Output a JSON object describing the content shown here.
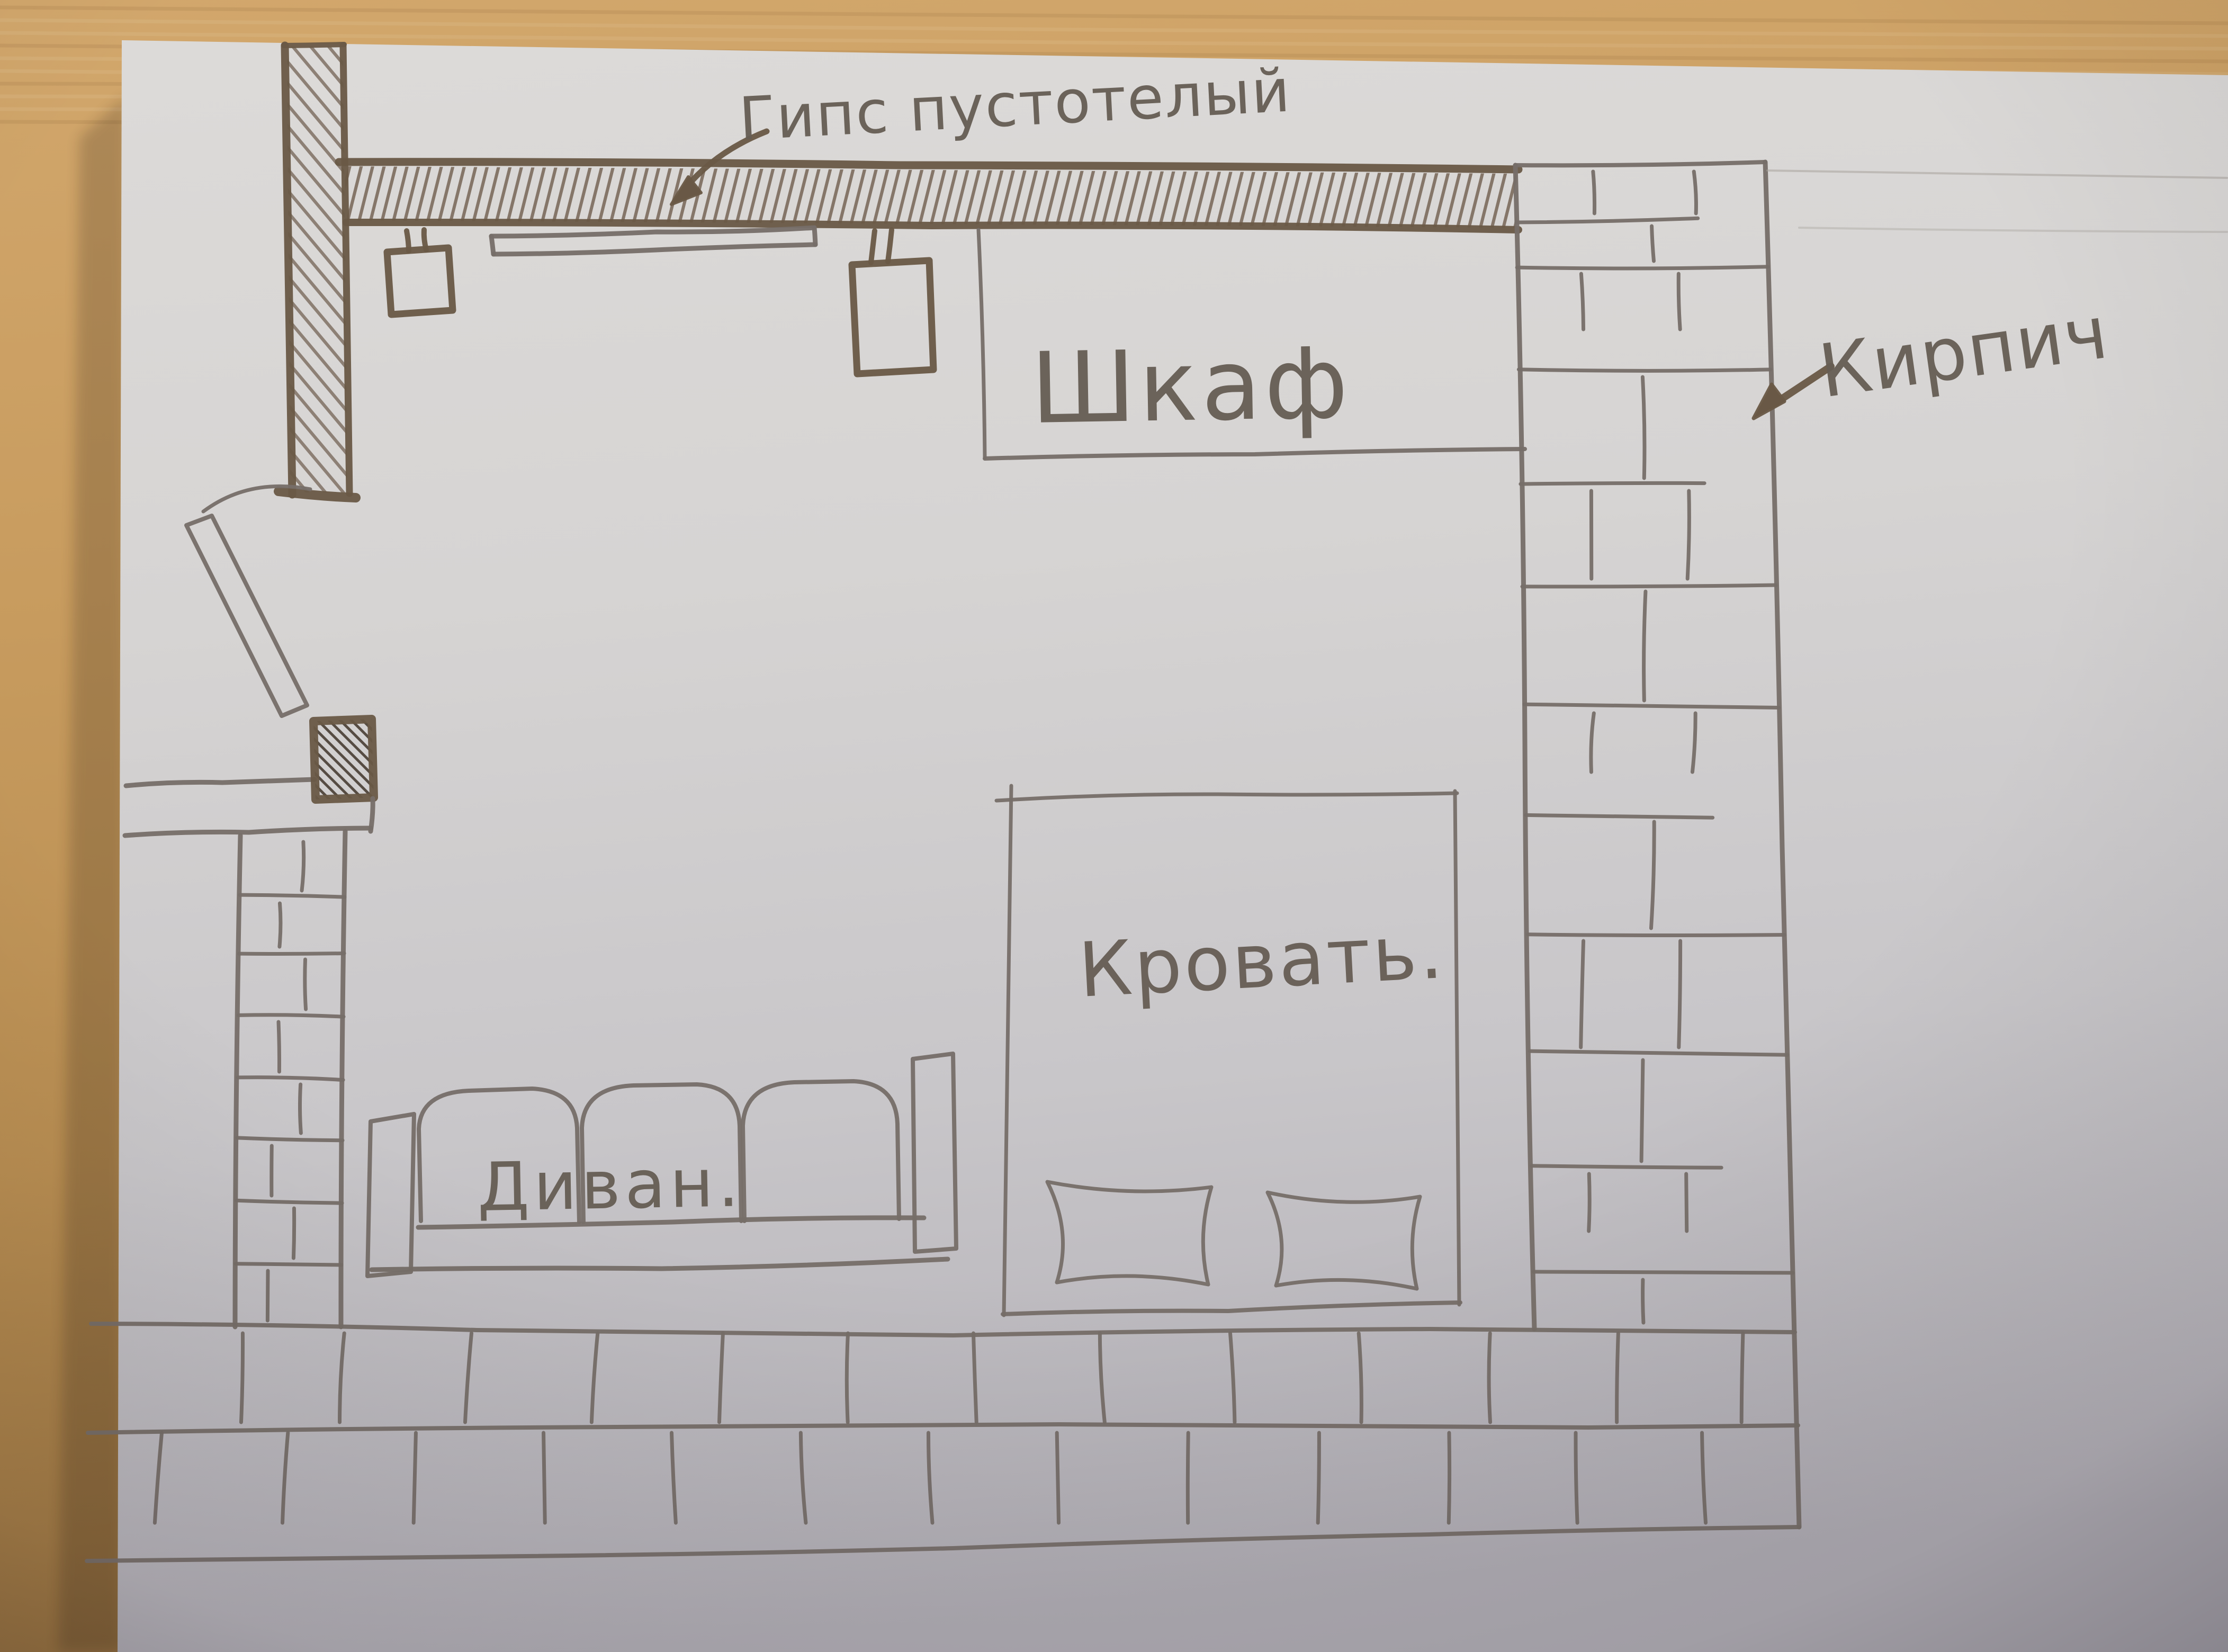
{
  "floor_plan": {
    "wall_annotations": [
      {
        "label": "Гипс пустотелый",
        "points_to": "top-hatched-wall"
      },
      {
        "label": "Кирпич",
        "points_to": "right-brick-wall"
      }
    ],
    "furniture": [
      {
        "label": "Шкаф"
      },
      {
        "label": "Кровать."
      },
      {
        "label": "Диван."
      }
    ]
  },
  "colors": {
    "wood_table": "#c59a5e",
    "paper": "#d6d4d3",
    "pencil": "#766e68",
    "marker_dark": "#695846"
  }
}
